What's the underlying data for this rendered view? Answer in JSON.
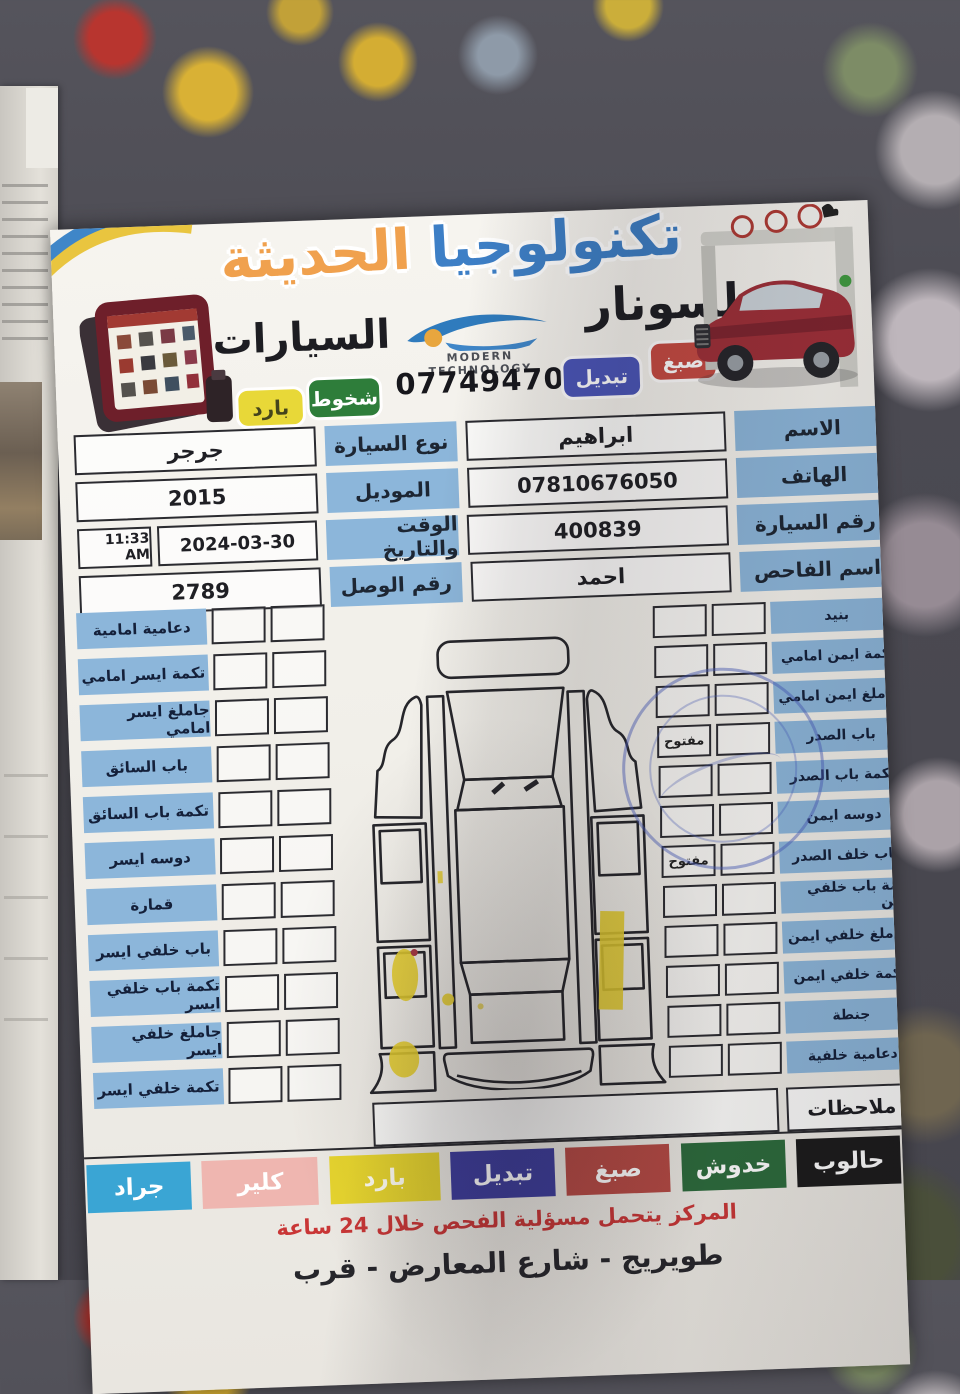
{
  "header": {
    "title_primary": "تكنولوجيا",
    "title_secondary": "الحديثة",
    "brand_right": "لسونار",
    "brand_left": "السيارات",
    "logo_caption": "MODERN TECHNOLOGY",
    "phone": "07749470885",
    "badges": [
      {
        "label": "صبغ",
        "bg": "#c64a42",
        "fg": "#ffffff"
      },
      {
        "label": "تبديل",
        "bg": "#4a55b8",
        "fg": "#ffffff"
      },
      {
        "label": "شخوط",
        "bg": "#2e7d3a",
        "fg": "#ffffff"
      },
      {
        "label": "بارد",
        "bg": "#e8d838",
        "fg": "#44441c"
      }
    ]
  },
  "icons": {
    "logo": "car-swoosh-icon",
    "stamp": "blue-round-inspection-stamp",
    "device": "diagnostic-tablet",
    "vehicle": "suv-under-scanner-gantry"
  },
  "info": {
    "name_label": "الاسم",
    "name_value": "ابراهيم",
    "phone_label": "الهاتف",
    "phone_value": "07810676050",
    "car_no_label": "رقم السيارة",
    "car_no_value": "400839",
    "inspector_label": "اسم الفاحص",
    "inspector_value": "احمد",
    "car_type_label": "نوع السيارة",
    "car_type_value": "جرجر",
    "model_label": "الموديل",
    "model_value": "2015",
    "datetime_label": "الوقت والتاريخ",
    "date_value": "2024-03-30",
    "time_value": "11:33 AM",
    "receipt_label": "رقم الوصل",
    "receipt_value": "2789"
  },
  "checklist": {
    "right": [
      {
        "label": "بنيد",
        "box1": "",
        "box2": ""
      },
      {
        "label": "تكمة ايمن امامي",
        "box1": "",
        "box2": ""
      },
      {
        "label": "جاملغ ايمن امامي",
        "box1": "",
        "box2": ""
      },
      {
        "label": "باب الصدر",
        "box1": "مفتوح",
        "box2": ""
      },
      {
        "label": "تكمة باب الصدر",
        "box1": "",
        "box2": ""
      },
      {
        "label": "دوسه ايمن",
        "box1": "",
        "box2": ""
      },
      {
        "label": "باب خلف الصدر",
        "box1": "مفتوح",
        "box2": ""
      },
      {
        "label": "تكمة باب خلفي ايمن",
        "box1": "",
        "box2": ""
      },
      {
        "label": "جاملغ خلفي ايمن",
        "box1": "",
        "box2": ""
      },
      {
        "label": "تكمة خلفي ايمن",
        "box1": "",
        "box2": ""
      },
      {
        "label": "جنطة",
        "box1": "",
        "box2": ""
      },
      {
        "label": "دعامية خلفية",
        "box1": "",
        "box2": ""
      }
    ],
    "left": [
      {
        "label": "دعامية امامية"
      },
      {
        "label": "تكمة ايسر امامي"
      },
      {
        "label": "جاملغ ايسر امامي"
      },
      {
        "label": "باب السائق"
      },
      {
        "label": "تكمة باب السائق"
      },
      {
        "label": "دوسه ايسر"
      },
      {
        "label": "قمارة"
      },
      {
        "label": "باب خلفي ايسر"
      },
      {
        "label": "تكمة باب خلفي ايسر"
      },
      {
        "label": "جاملغ خلفي ايسر"
      },
      {
        "label": "تكمة خلفي ايسر"
      }
    ]
  },
  "notes": {
    "label": "ملاحظات",
    "value": ""
  },
  "legend": [
    {
      "label": "حالوب",
      "bg": "#1b1b1b",
      "fg": "#ffffff"
    },
    {
      "label": "خدوش",
      "bg": "#2c6b3c",
      "fg": "#ffffff"
    },
    {
      "label": "صبغ",
      "bg": "#b64a44",
      "fg": "#ffffff"
    },
    {
      "label": "تبديل",
      "bg": "#3d3d9c",
      "fg": "#ffffff"
    },
    {
      "label": "بارد",
      "bg": "#e6d42e",
      "fg": "#fffdf2"
    },
    {
      "label": "كلير",
      "bg": "#efb6b0",
      "fg": "#ffffff"
    },
    {
      "label": "جراد",
      "bg": "#3aa5d4",
      "fg": "#ffffff"
    }
  ],
  "footer": {
    "disclaimer": "المركز يتحمل مسؤلية الفحص خلال 24 ساعة",
    "address": "طويريج - شارع المعارض - قرب"
  }
}
